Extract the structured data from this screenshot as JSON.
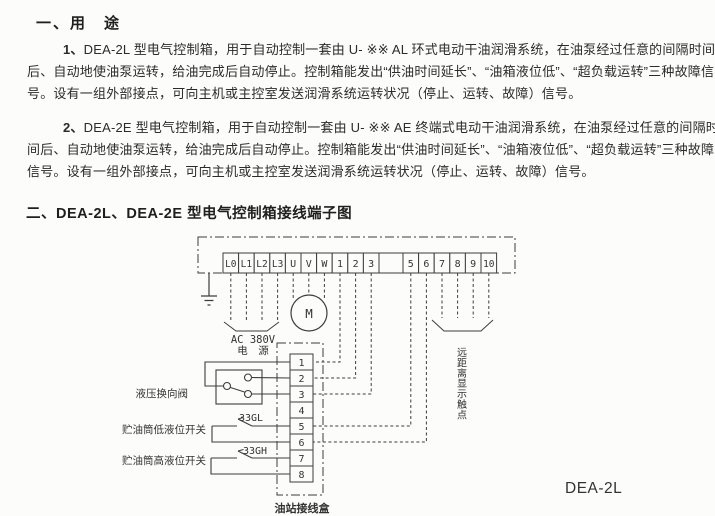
{
  "sections": {
    "usage": {
      "heading": "一、用　途",
      "paragraphs": [
        {
          "lead": "1、",
          "lines": [
            "DEA-2L 型电气控制箱，用于自动控制一套由 U- ※※ AL 环式电动干油润滑系统，在油泵经过任意的间隔时间",
            "后、自动地使油泵运转，给油完成后自动停止。控制箱能发出“供油时间延长”、“油箱液位低”、“超负载运转”三种故障信",
            "号。设有一组外部接点，可向主机或主控室发送润滑系统运转状况（停止、运转、故障）信号。"
          ]
        },
        {
          "lead": "2、",
          "lines": [
            "DEA-2E 型电气控制箱，用于自动控制一套由 U- ※※ AE 终端式电动干油润滑系统，在油泵经过任意的间隔时",
            "间后、自动地使油泵运转，给油完成后自动停止。控制箱能发出“供油时间延长”、“油箱液位低”、“超负载运转”三种故障",
            "信号。设有一组外部接点，可向主机或主控室发送润滑系统运转状况（停止、运转、故障）信号。"
          ]
        }
      ]
    },
    "diagram_section": {
      "heading": "二、DEA-2L、DEA-2E 型电气控制箱接线端子图"
    }
  },
  "diagram": {
    "terminal_labels": [
      "L0",
      "L1",
      "L2",
      "L3",
      "U",
      "V",
      "W",
      "1",
      "2",
      "3",
      "",
      "5",
      "6",
      "7",
      "8",
      "9",
      "10"
    ],
    "junction_labels": [
      "1",
      "2",
      "3",
      "4",
      "5",
      "6",
      "7",
      "8"
    ],
    "motor_label": "M",
    "power_label_line1": "AC 380V",
    "power_label_line2": "电　源",
    "remote_label": "远距离显示触点",
    "valve_label": "液压换向阀",
    "low_switch_label": "贮油筒低液位开关",
    "low_switch_tag": "33GL",
    "high_switch_label": "贮油筒高液位开关",
    "high_switch_tag": "33GH",
    "junction_box_label": "油站接线盒",
    "model_label": "DEA-2L",
    "line_color": "#3d3d3d"
  }
}
